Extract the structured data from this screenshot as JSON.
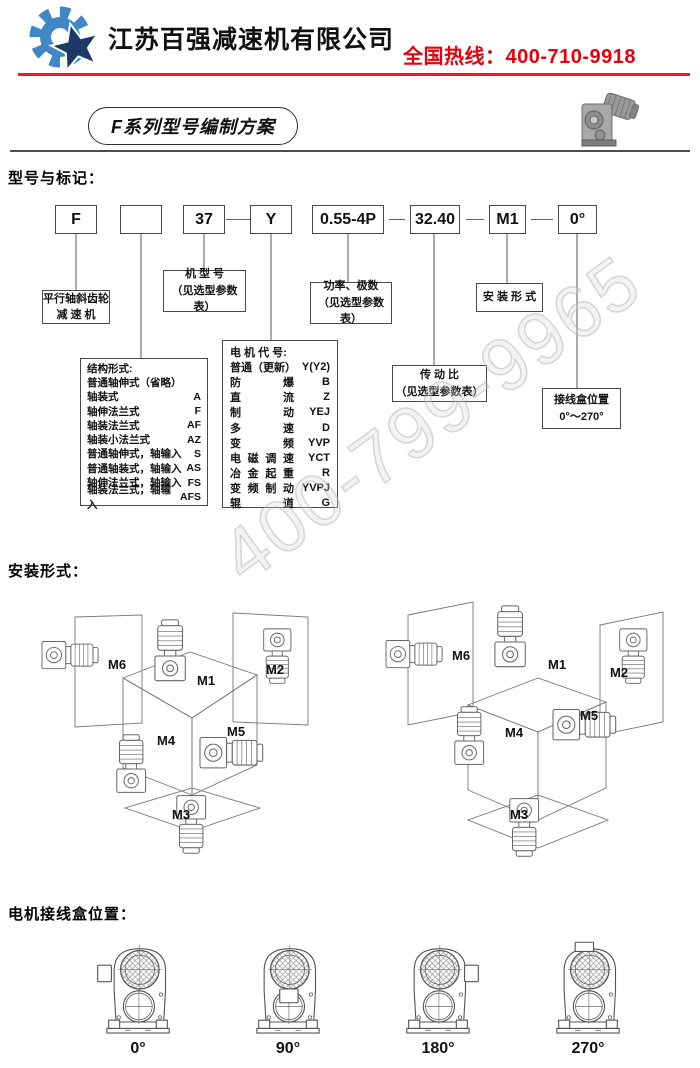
{
  "header": {
    "company": "江苏百强减速机有限公司",
    "hotline": "全国热线：400-710-9918",
    "accent_color": "#e8000d"
  },
  "title_badge": "F系列型号编制方案",
  "watermark": "400-799-9965",
  "model_section": {
    "heading": "型号与标记：",
    "code_boxes": [
      "F",
      "",
      "37",
      "Y",
      "0.55-4P",
      "32.40",
      "M1",
      "0°"
    ],
    "callouts": {
      "reducer": {
        "line1": "平行轴斜齿轮",
        "line2": "减 速 机"
      },
      "frame": {
        "line1": "机 型 号",
        "line2": "（见选型参数表）"
      },
      "power": {
        "line1": "功率、极数",
        "line2": "（见选型参数表）"
      },
      "mounting": {
        "line1": "安 装 形 式"
      },
      "ratio": {
        "line1": "传 动 比",
        "line2": "（见选型参数表）"
      },
      "junction": {
        "line1": "接线盒位置",
        "line2": "0°～270°"
      }
    },
    "structure_box": {
      "title": "结构形式:",
      "rows": [
        {
          "label": "普通轴伸式（省略）",
          "code": ""
        },
        {
          "label": "轴装式",
          "code": "A"
        },
        {
          "label": "轴伸法兰式",
          "code": "F"
        },
        {
          "label": "轴装法兰式",
          "code": "AF"
        },
        {
          "label": "轴装小法兰式",
          "code": "AZ"
        },
        {
          "label": "普通轴伸式，轴输入",
          "code": "S"
        },
        {
          "label": "普通轴装式，轴输入",
          "code": "AS"
        },
        {
          "label": "轴伸法兰式，轴输入",
          "code": "FS"
        },
        {
          "label": "轴装法兰式，轴输入",
          "code": "AFS"
        }
      ]
    },
    "motor_box": {
      "title": "电 机 代 号:",
      "rows": [
        {
          "label": "普通（更新）",
          "code": "Y(Y2)"
        },
        {
          "label": "防爆",
          "code": "B"
        },
        {
          "label": "直流",
          "code": "Z"
        },
        {
          "label": "制动",
          "code": "YEJ"
        },
        {
          "label": "多速",
          "code": "D"
        },
        {
          "label": "变频",
          "code": "YVP"
        },
        {
          "label": "电磁调速",
          "code": "YCT"
        },
        {
          "label": "冶金起重",
          "code": "R"
        },
        {
          "label": "变频制动",
          "code": "YVPJ"
        },
        {
          "label": "辊道",
          "code": "G"
        }
      ]
    }
  },
  "mounting_section": {
    "heading": "安装形式：",
    "labels": {
      "m1": "M1",
      "m2": "M2",
      "m3": "M3",
      "m4": "M4",
      "m5": "M5",
      "m6": "M6"
    }
  },
  "junction_section": {
    "heading": "电机接线盒位置：",
    "angles": [
      "0°",
      "90°",
      "180°",
      "270°"
    ]
  }
}
